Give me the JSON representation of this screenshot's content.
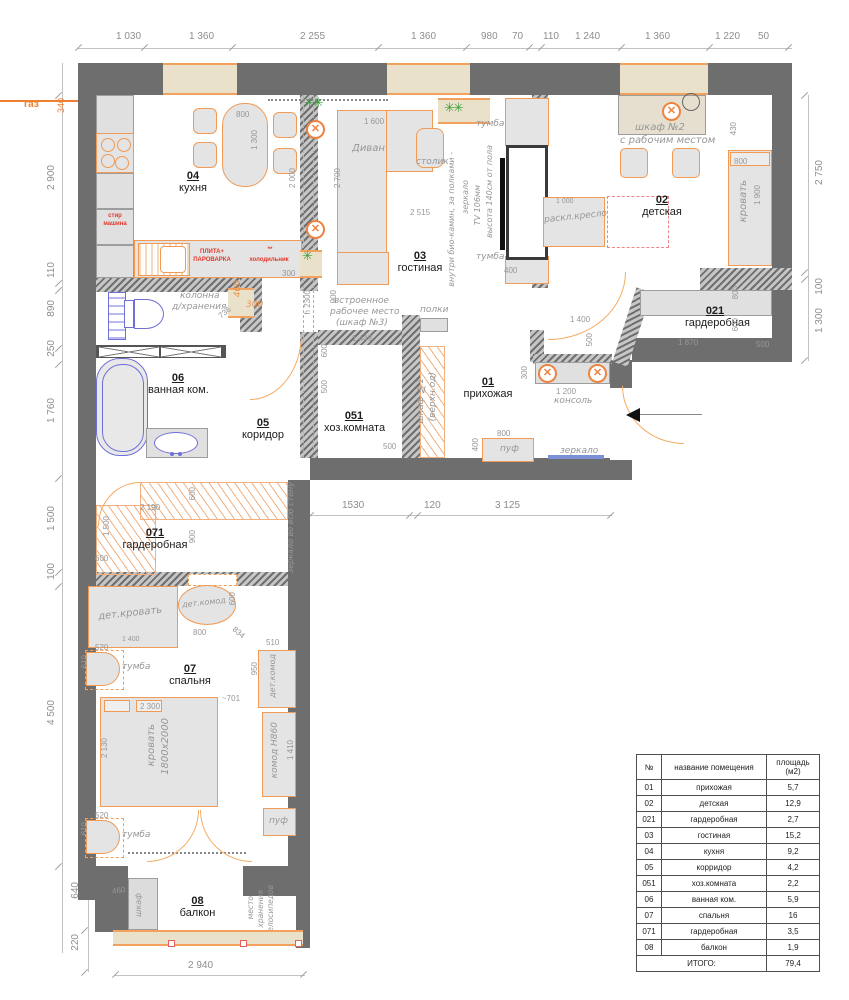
{
  "dims": {
    "top": [
      "1 030",
      "1 360",
      "2 255",
      "1 360",
      "980",
      "70",
      "110",
      "1 240",
      "1 360",
      "1 220",
      "50"
    ],
    "left": [
      "2 900",
      "110",
      "890",
      "250",
      "1 760",
      "1 500",
      "100",
      "4 500",
      "640",
      "220"
    ],
    "right": [
      "2 750",
      "100",
      "1 300"
    ],
    "bottom_mid": [
      "1530",
      "120",
      "3 125"
    ],
    "bottom": "2 940",
    "gas_label": "газ",
    "gas_dim": "340"
  },
  "rooms": {
    "kitchen": {
      "num": "04",
      "name": "кухня"
    },
    "living": {
      "num": "03",
      "name": "гостиная"
    },
    "nursery": {
      "num": "02",
      "name": "детская"
    },
    "wardrobe021": {
      "num": "021",
      "name": "гардеробная"
    },
    "hall": {
      "num": "01",
      "name": "прихожая"
    },
    "utility": {
      "num": "051",
      "name": "хоз.комната"
    },
    "bath": {
      "num": "06",
      "name": "ванная ком."
    },
    "corridor": {
      "num": "05",
      "name": "коридор"
    },
    "wardrobe071": {
      "num": "071",
      "name": "гардеробная"
    },
    "bedroom": {
      "num": "07",
      "name": "спальня"
    },
    "balcony": {
      "num": "08",
      "name": "балкон"
    }
  },
  "kitchen": {
    "washer": "стир машина",
    "stove": "ПЛИТА+ ПАРОВАРКА",
    "fridge": "холодильник",
    "fridge_mark": "**",
    "d_800": "800",
    "d_1300": "1 300",
    "d_2000": "2 000",
    "d_300": "300"
  },
  "living": {
    "sofa": "Диван",
    "coffee_table": "столик",
    "tumba_top": "тумба",
    "tumba_bottom": "тумба",
    "note1": "внутри био-камин, за полками -",
    "note2": "зеркало",
    "note3": "TV 106мм",
    "note4": "высота 140см от пола",
    "d_1600": "1 600",
    "d_2700": "2 700",
    "d_2515": "2 515",
    "d_400": "400",
    "d_h2300": "h 2300"
  },
  "nursery": {
    "closet_line1": "шкаф №2",
    "closet_line2": "с рабочим местом",
    "armchair": "раскл.кресло",
    "bed": "кровать",
    "d_430": "430",
    "d_800": "800",
    "d_1900": "1 900",
    "d_1000": "1 000"
  },
  "wardrobe021": {
    "d_1870": "1 870",
    "d_500": "500",
    "d_800": "800",
    "d_600": "600"
  },
  "hall": {
    "console": "консоль",
    "pouf": "пуф",
    "mirror": "зеркало",
    "shelves": "полки",
    "closet_line1": "шкаф №1",
    "closet_line2": "(верхн.од)",
    "d_1400": "1 400",
    "d_500": "500",
    "d_1200": "1 200",
    "d_300": "300",
    "d_800": "800",
    "d_400": "400"
  },
  "utility": {
    "note_line1": "встроенное",
    "note_line2": "рабочее место",
    "note_line3": "(шкаф №3)",
    "d_1449": "1 449",
    "d_600": "600",
    "d_900": "900",
    "d_500": "500",
    "d_500b": "500"
  },
  "bath": {
    "column_line1": "колонна",
    "column_line2": "д/хранения",
    "d_736": "736",
    "d_300": "300",
    "d_400": "400"
  },
  "wardrobe071": {
    "d_2190": "2 190",
    "d_600": "600",
    "d_900": "900",
    "d_600b": "600",
    "d_1500": "1 500",
    "mirror_note": "зеркало во всю стену"
  },
  "bedroom": {
    "bed": "кровать",
    "bed_size": "1800х2000",
    "tumba_top": "тумба",
    "tumba_bottom": "тумба",
    "kid_bed": "дет.кровать",
    "kid_dresser_oval": "дет.комод",
    "kid_dresser_right": "дет.комод",
    "dresser": "комод H860",
    "pouf": "пуф",
    "d_2300": "2 300",
    "d_2130": "2 130",
    "d_701": "~701",
    "d_950": "950",
    "d_510": "510",
    "d_520a": "520",
    "d_610a": "610",
    "d_520b": "520",
    "d_610b": "610",
    "d_800": "800",
    "d_834": "834",
    "d_600": "600",
    "d_1410": "1 410",
    "d_1400": "1 400"
  },
  "balcony": {
    "closet": "шкаф",
    "d_460": "460",
    "storage_line1": "место",
    "storage_line2": "хранения",
    "storage_line3": "велосипедов"
  },
  "table": {
    "headers": [
      "№",
      "название помещения",
      "площадь (м2)"
    ],
    "rows": [
      [
        "01",
        "прихожая",
        "5,7"
      ],
      [
        "02",
        "детская",
        "12,9"
      ],
      [
        "021",
        "гардеробная",
        "2,7"
      ],
      [
        "03",
        "гостиная",
        "15,2"
      ],
      [
        "04",
        "кухня",
        "9,2"
      ],
      [
        "05",
        "корридор",
        "4,2"
      ],
      [
        "051",
        "хоз.комната",
        "2,2"
      ],
      [
        "06",
        "ванная ком.",
        "5,9"
      ],
      [
        "07",
        "спальня",
        "16"
      ],
      [
        "071",
        "гардеробная",
        "3,5"
      ],
      [
        "08",
        "балкон",
        "1,9"
      ]
    ],
    "total_label": "ИТОГО:",
    "total_value": "79,4"
  }
}
